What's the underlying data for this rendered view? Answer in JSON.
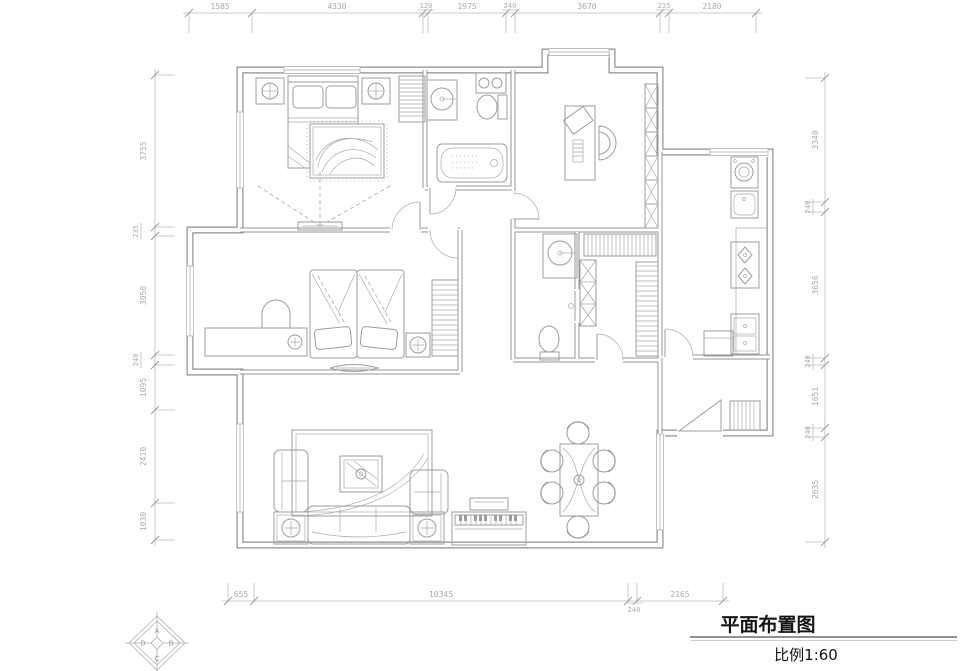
{
  "drawing": {
    "title": "平面布置图",
    "scale": "比例1:60"
  },
  "dimensions": {
    "top": [
      "1585",
      "4330",
      "120",
      "1975",
      "240",
      "3670",
      "235",
      "2180"
    ],
    "left": [
      "3755",
      "235",
      "3050",
      "240",
      "1095",
      "2410",
      "1030"
    ],
    "right": [
      "3340",
      "240",
      "3656",
      "240",
      "1651",
      "240",
      "2635"
    ],
    "bottom": [
      "655",
      "10345",
      "240",
      "2165"
    ]
  },
  "elevation_marker": {
    "top": "A",
    "right": "B",
    "bottom": "C",
    "left": "D"
  },
  "colors": {
    "background": "#ffffff",
    "wall_line": "#8f8f8f",
    "furniture_line": "#9d9d9d",
    "dimension_line": "#bcbcbc",
    "dimension_text": "#ababab",
    "title_text": "#141414"
  }
}
